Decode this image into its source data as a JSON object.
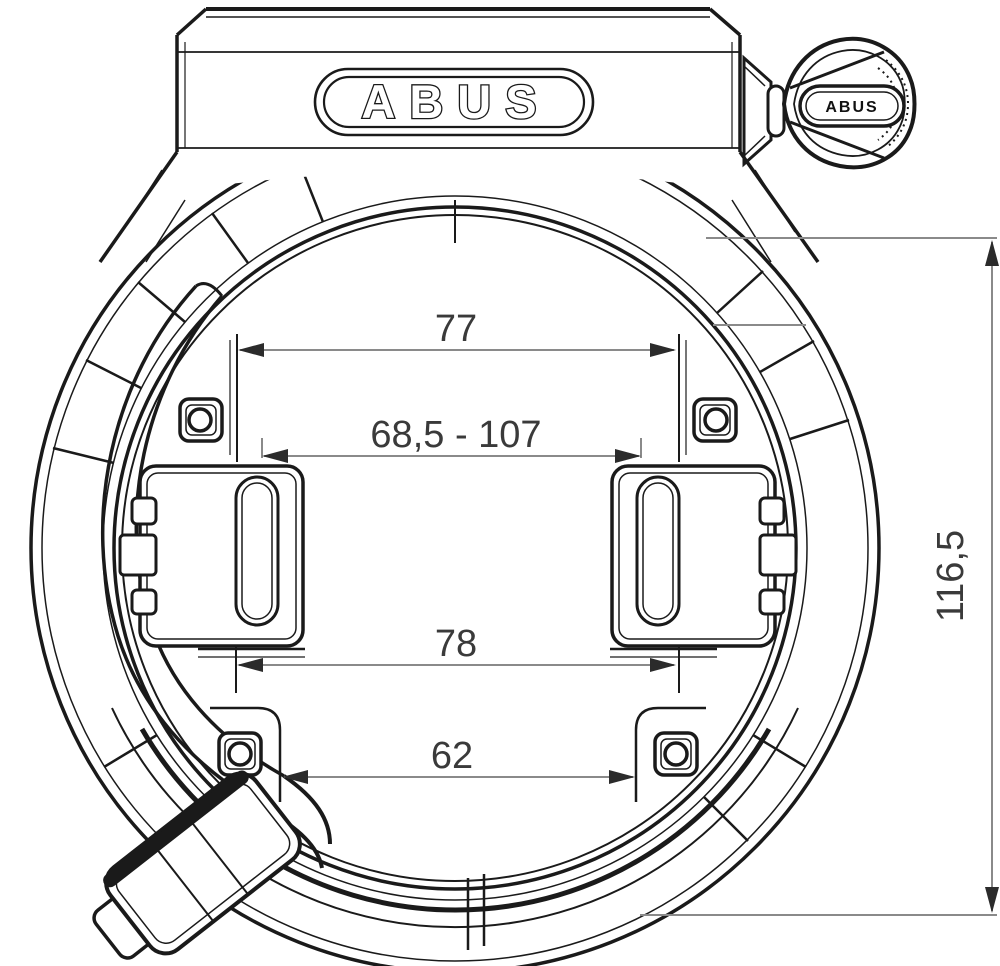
{
  "branding": {
    "housing_logo": "ABUS",
    "key_logo": "ABUS"
  },
  "dimensions": {
    "upper_inner_width": {
      "label": "77"
    },
    "clamp_width_range": {
      "label": "68,5 - 107"
    },
    "bracket_outer_width": {
      "label": "78"
    },
    "lower_inner_width": {
      "label": "62"
    },
    "overall_height": {
      "label": "116,5"
    }
  }
}
